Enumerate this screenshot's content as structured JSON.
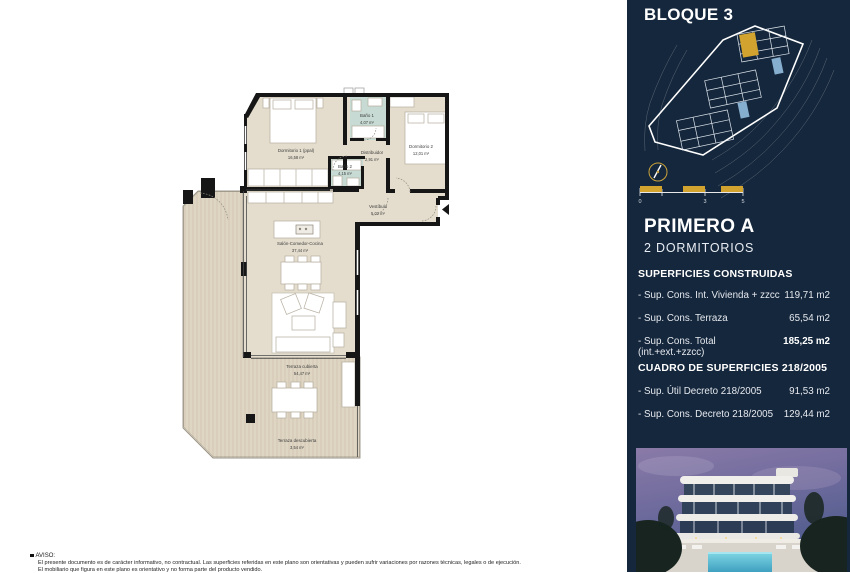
{
  "right_panel": {
    "title": "BLOQUE 3",
    "unit_title": "PRIMERO A",
    "unit_subtitle": "2 DORMITORIOS",
    "scale_labels": [
      "0",
      "3",
      "5"
    ],
    "surfaces_title": "SUPERFICIES CONSTRUIDAS",
    "surfaces": [
      {
        "label": "- Sup. Cons. Int. Vivienda + zzcc",
        "value": "119,71 m2"
      },
      {
        "label": "- Sup. Cons. Terraza",
        "value": "65,54 m2"
      },
      {
        "label": "- Sup. Cons. Total (int.+ext.+zzcc)",
        "value": "185,25 m2"
      }
    ],
    "cuadro_title": "CUADRO DE SUPERFICIES 218/2005",
    "cuadro": [
      {
        "label": "- Sup. Útil Decreto 218/2005",
        "value": "91,53 m2"
      },
      {
        "label": "- Sup. Cons. Decreto 218/2005",
        "value": "129,44 m2"
      }
    ]
  },
  "floor_plan": {
    "rooms": [
      {
        "name": "Dormitorio 1 (ppal)",
        "area": "16,58 m²"
      },
      {
        "name": "Baño 1",
        "area": "4,07 m²"
      },
      {
        "name": "Distribuidor",
        "area": "2,91 m²"
      },
      {
        "name": "Dormitorio 2",
        "area": "12,01 m²"
      },
      {
        "name": "Baño 2",
        "area": "4,15 m²"
      },
      {
        "name": "Vestíbulo",
        "area": "5,02 m²"
      },
      {
        "name": "Salón-Comedor-Cocina",
        "area": "37,44 m²"
      },
      {
        "name": "Terraza cubierta",
        "area": "54,47 m²"
      },
      {
        "name": "Terraza descubierta",
        "area": "3,54 m²"
      }
    ]
  },
  "footer": {
    "aviso_title": "AVISO:",
    "line1": "El presente documento es de carácter informativo, no contractual. Las superficies referidas en este plano son orientativas y pueden sufrir variaciones por razones técnicas, legales o de ejecución.",
    "line2": "El mobiliario que figura en este plano es orientativo y no forma parte del producto vendido."
  },
  "colors": {
    "panel_navy": "#15273c",
    "accent_gold": "#d2a42f",
    "floor_beige": "#e4ddcd",
    "bath_teal": "#c7dbd4",
    "wall_black": "#161616",
    "pool_blue": "#86aecf"
  }
}
